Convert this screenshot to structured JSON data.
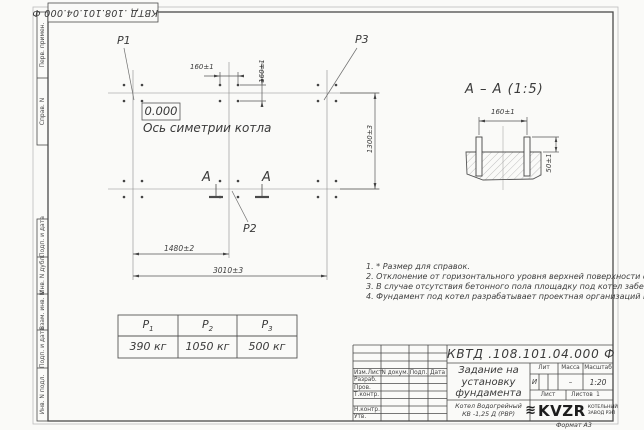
{
  "sheet": {
    "stamp_top": "КВТД .108.101.04.000 Ф",
    "format_note": "Формат А3"
  },
  "margin_columns": {
    "col1": "Перв. примен.",
    "col2": "Справ. N",
    "col3": "Подп. и дата",
    "col4": "Инв. N дубл.",
    "col5": "Взам. инв. N",
    "col6": "Подп. и дата",
    "col7": "Инв. N подл."
  },
  "plan": {
    "p1": "Р1",
    "p2": "Р2",
    "p3": "Р3",
    "elevation": "0.000",
    "axis_label": "Ось симетрии котла",
    "dim_bolt_h": "160±1",
    "dim_bolt_v": "160±1",
    "dim_width": "1300±3",
    "dim_left": "1480±2",
    "dim_total": "3010±3",
    "section_letter_left": "А",
    "section_letter_right": "А"
  },
  "section_view": {
    "title": "А – А (1:5)",
    "dim_spacing": "160±1",
    "dim_height": "50±1"
  },
  "notes": {
    "n1": "1. * Размер для справок.",
    "n2": "2. Отклонение от горизонтального уровня верхней поверхности фундамента не более 10 мм.",
    "n3": "3. В случае отсутствия бетонного пола площадку под котел забетонировать. Расстояние от осей крайних колонн до края бетонной подушки 500 мм.",
    "n4": "4. Фундамент под котел разрабатывает проектная организаций по нагрузкам на фундамент."
  },
  "load_table": {
    "cols": [
      {
        "base": "Р",
        "sub": "1",
        "value": "390 кг"
      },
      {
        "base": "Р",
        "sub": "2",
        "value": "1050 кг"
      },
      {
        "base": "Р",
        "sub": "3",
        "value": "500 кг"
      }
    ]
  },
  "title_block": {
    "doc_number": "КВТД .108.101.04.000 Ф",
    "title_line1": "Задание на",
    "title_line2": "установку",
    "title_line3": "фундамента",
    "product_line1": "Котел Водогрейный",
    "product_line2": "КВ -1,25 Д (РВР)",
    "h_izm": "Изм.Лист",
    "h_doc": "N докум.",
    "h_podp": "Подп.",
    "h_data": "Дата",
    "r1": "Разраб.",
    "r2": "Пров.",
    "r3": "Т.контр.",
    "r4": "Н.контр.",
    "r5": "Утв.",
    "lit_label": "Лит",
    "mass_label": "Масса",
    "scale_label": "Масштаб",
    "lit_value": "И",
    "mass_value": "–",
    "scale_value": "1:20",
    "sheet_label": "Лист",
    "sheets_label": "Листов",
    "sheets_value": "1",
    "logo_icon": "≋",
    "logo_text": "KVZR",
    "logo_sub1": "КОТЕЛЬНЫЙ",
    "logo_sub2": "ЗАВОД РЭП"
  }
}
